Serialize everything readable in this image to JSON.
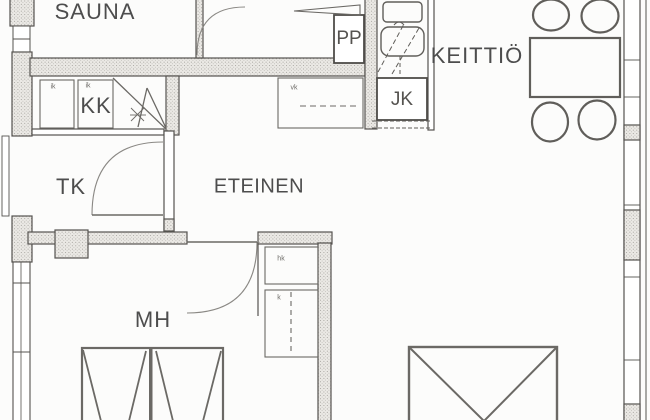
{
  "plan": {
    "type": "apartment-floor-plan",
    "rooms": [
      {
        "id": "sauna",
        "label": "SAUNA"
      },
      {
        "id": "kk",
        "label": "KK"
      },
      {
        "id": "tk",
        "label": "TK"
      },
      {
        "id": "eteinen",
        "label": "ETEINEN"
      },
      {
        "id": "keittio",
        "label": "KEITTIÖ"
      },
      {
        "id": "mh",
        "label": "MH"
      }
    ],
    "appliances": [
      {
        "id": "pp",
        "label": "PP"
      },
      {
        "id": "jk",
        "label": "JK"
      }
    ],
    "closet_symbols": [
      {
        "id": "ik-1",
        "label": "ik"
      },
      {
        "id": "ik-2",
        "label": "ik"
      },
      {
        "id": "vk",
        "label": "vk"
      },
      {
        "id": "hk",
        "label": "hk"
      },
      {
        "id": "k",
        "label": "k"
      }
    ],
    "colors": {
      "wall_line": "#55534f",
      "wall_fill": "#ebe9e5",
      "furniture_line": "#6b6965",
      "door_arc": "#8a8884",
      "text": "#4d4d4d",
      "background": "#fcfcfb"
    }
  }
}
